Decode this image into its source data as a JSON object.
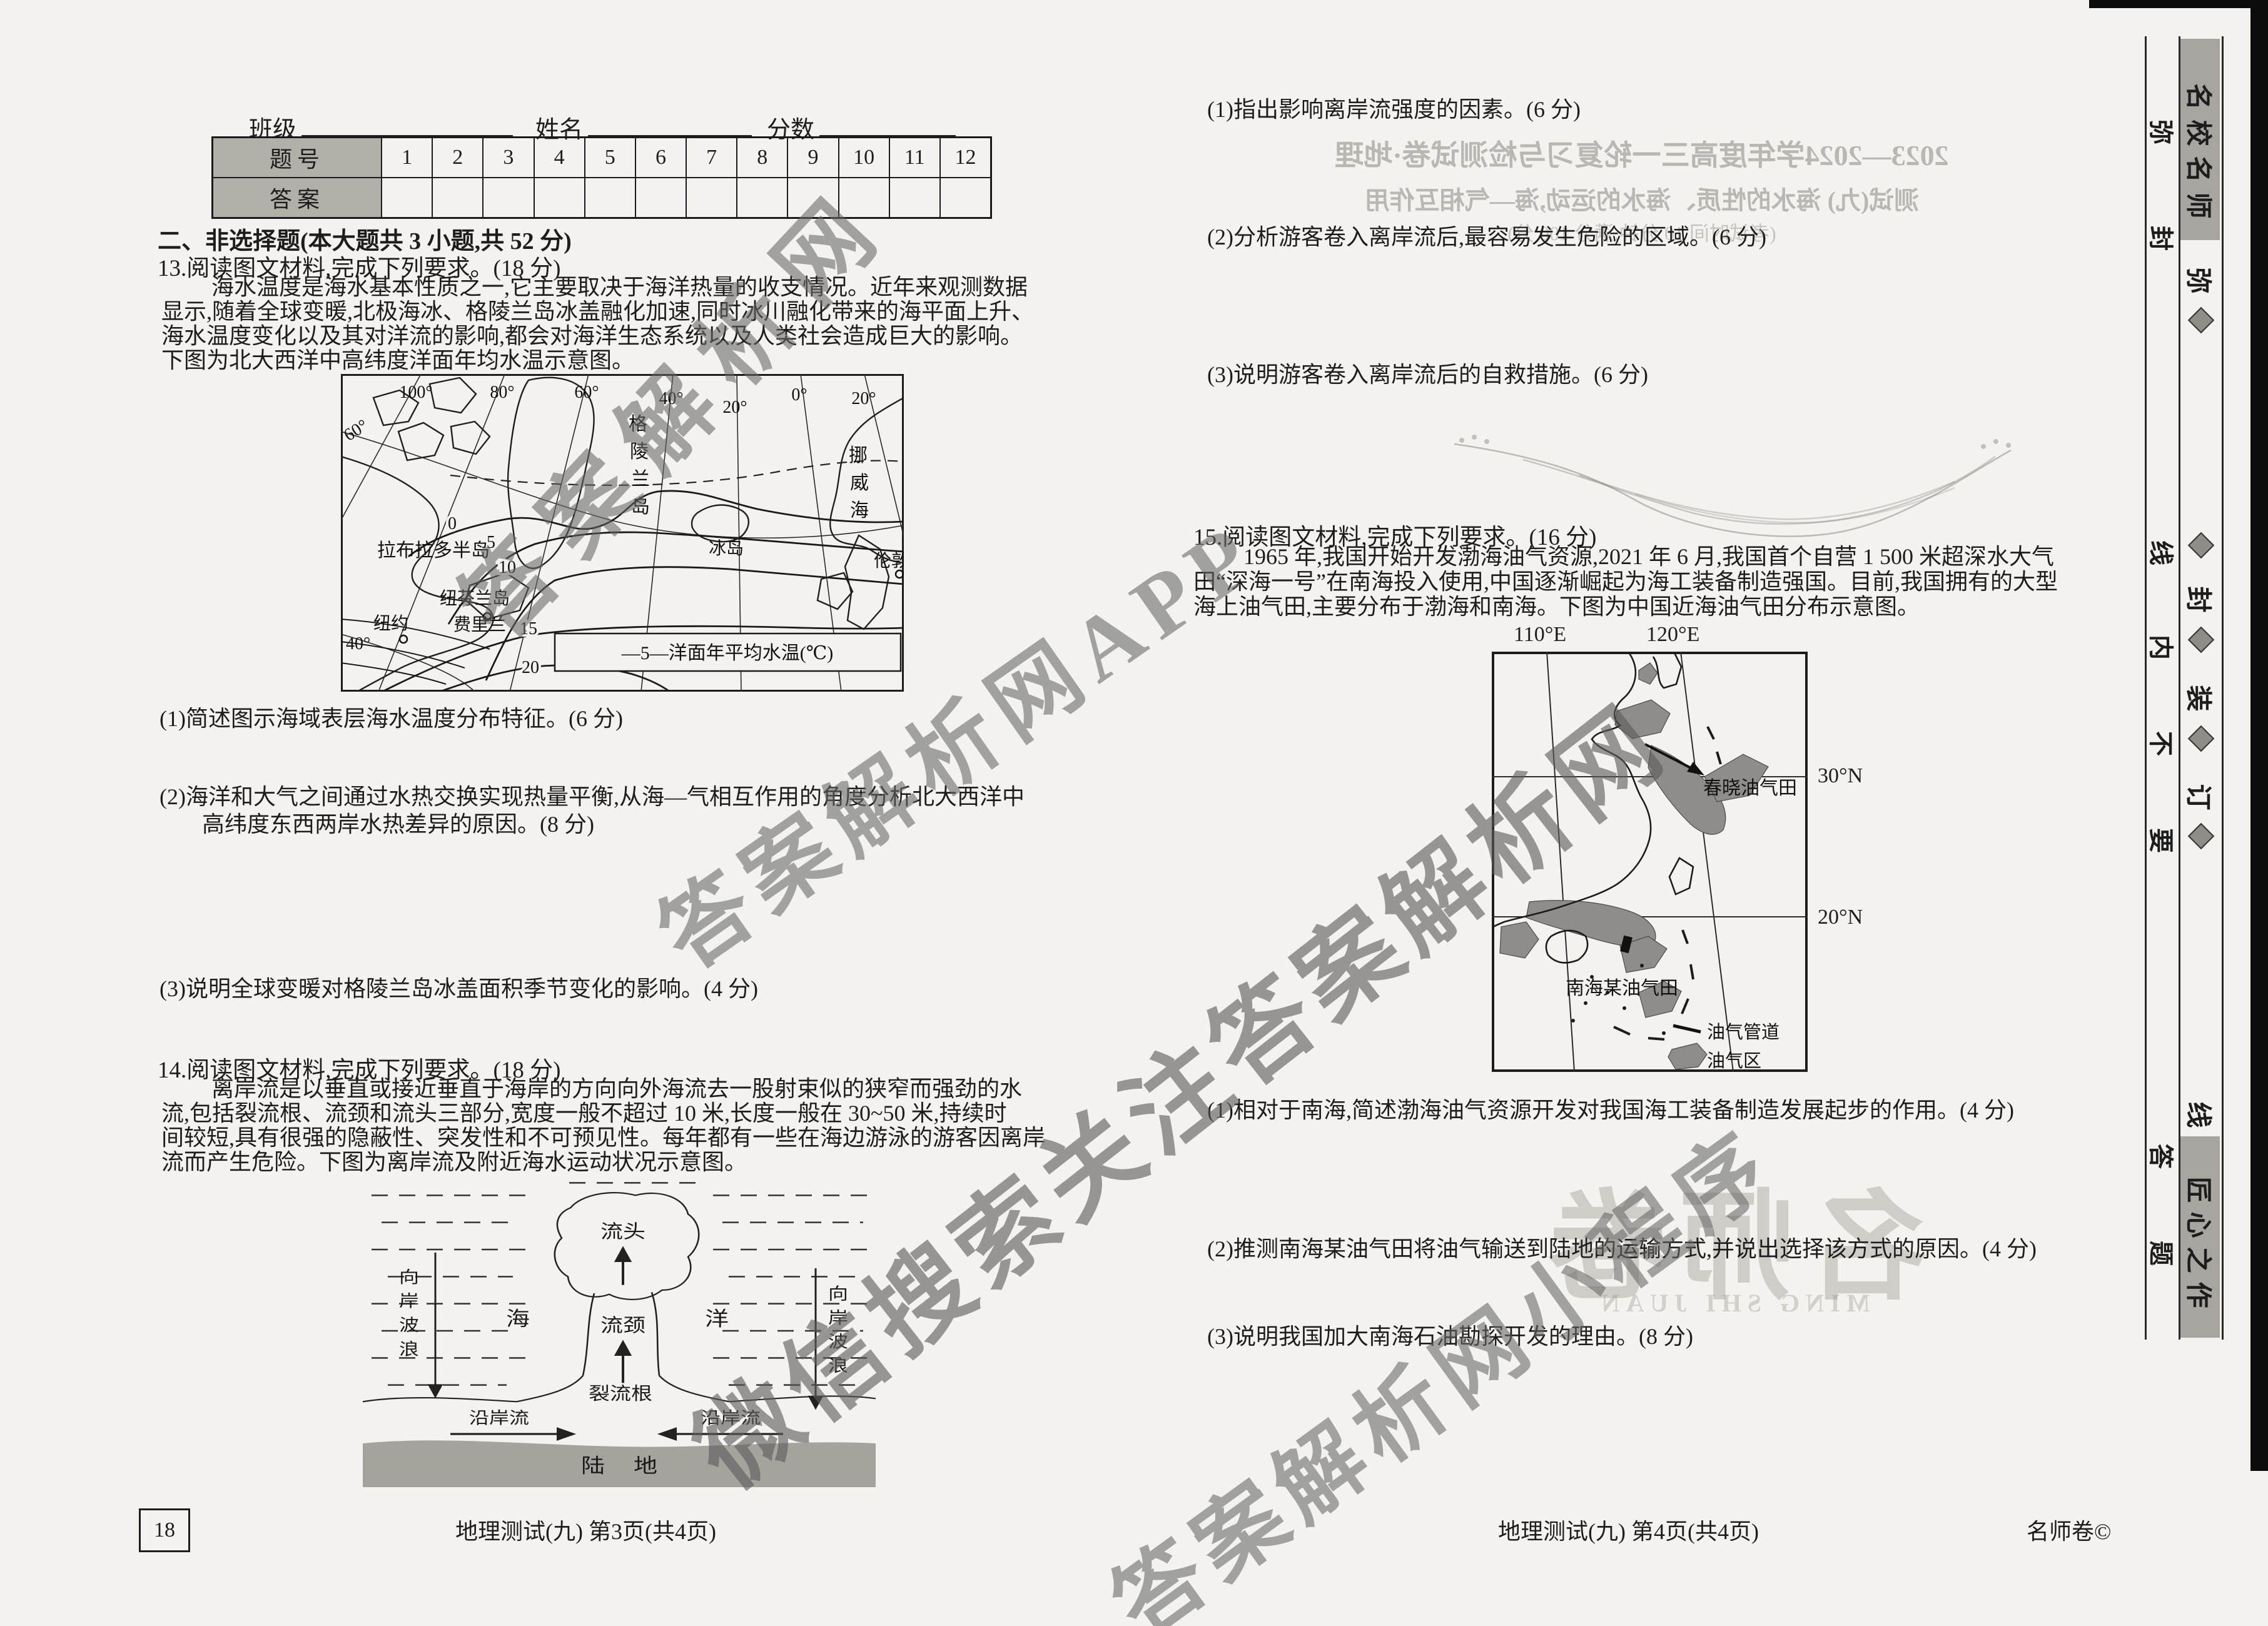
{
  "header": {
    "class_label": "班级",
    "name_label": "姓名",
    "score_label": "分数"
  },
  "answer_table": {
    "row_header": "题号",
    "answer_header": "答案",
    "numbers": [
      "1",
      "2",
      "3",
      "4",
      "5",
      "6",
      "7",
      "8",
      "9",
      "10",
      "11",
      "12"
    ]
  },
  "left": {
    "section_title": "二、非选择题(本大题共 3 小题,共 52 分)",
    "q13": {
      "stem": "13.阅读图文材料,完成下列要求。(18 分)",
      "para": [
        "海水温度是海水基本性质之一,它主要取决于海洋热量的收支情况。近年来观测数据",
        "显示,随着全球变暖,北极海冰、格陵兰岛冰盖融化加速,同时冰川融化带来的海平面上升、",
        "海水温度变化以及其对洋流的影响,都会对海洋生态系统以及人类社会造成巨大的影响。",
        "下图为北大西洋中高纬度洋面年均水温示意图。"
      ],
      "sub1": "(1)简述图示海域表层海水温度分布特征。(6 分)",
      "sub2_l1": "(2)海洋和大气之间通过水热交换实现热量平衡,从海—气相互作用的角度分析北大西洋中",
      "sub2_l2": "高纬度东西两岸水热差异的原因。(8 分)",
      "sub3": "(3)说明全球变暖对格陵兰岛冰盖面积季节变化的影响。(4 分)"
    },
    "map13": {
      "lon": [
        "100°",
        "80°",
        "60°",
        "40°",
        "20°",
        "0°",
        "20°"
      ],
      "lat_top": "60°",
      "lat_bottom": "40°",
      "iso": [
        "0",
        "5",
        "10",
        "15",
        "20"
      ],
      "greenland": [
        "格",
        "陵",
        "兰",
        "岛"
      ],
      "norwegian_sea": [
        "挪",
        "威",
        "海"
      ],
      "iceland": "冰岛",
      "labrador": "拉布拉多半岛",
      "newfoundland": "纽芬兰岛",
      "ferryland": "费里兰",
      "newyork": "纽约",
      "london": "伦敦",
      "legend": "—5—洋面年平均水温(℃)"
    },
    "q14": {
      "stem": "14.阅读图文材料,完成下列要求。(18 分)",
      "para": [
        "离岸流是以垂直或接近垂直于海岸的方向向外海流去一股射束似的狭窄而强劲的水",
        "流,包括裂流根、流颈和流头三部分,宽度一般不超过 10 米,长度一般在 30~50 米,持续时",
        "间较短,具有很强的隐蔽性、突发性和不可预见性。每年都有一些在海边游泳的游客因离岸",
        "流而产生危险。下图为离岸流及附近海水运动状况示意图。"
      ]
    },
    "fig14": {
      "head": "流头",
      "neck": "流颈",
      "root": "裂流根",
      "sea": "海",
      "ocean": "洋",
      "onshore": [
        "向",
        "岸",
        "波",
        "浪"
      ],
      "longshore": "沿岸流",
      "land": [
        "陆",
        "地"
      ]
    }
  },
  "right": {
    "q14_sub1": "(1)指出影响离岸流强度的因素。(6 分)",
    "q14_sub2": "(2)分析游客卷入离岸流后,最容易发生危险的区域。(6 分)",
    "q14_sub3": "(3)说明游客卷入离岸流后的自救措施。(6 分)",
    "q15": {
      "stem": "15.阅读图文材料,完成下列要求。(16 分)",
      "para": [
        "1965 年,我国开始开发渤海油气资源,2021 年 6 月,我国首个自营 1 500 米超深水大气",
        "田“深海一号”在南海投入使用,中国逐渐崛起为海工装备制造强国。目前,我国拥有的大型",
        "海上油气田,主要分布于渤海和南海。下图为中国近海油气田分布示意图。"
      ],
      "sub1": "(1)相对于南海,简述渤海油气资源开发对我国海工装备制造发展起步的作用。(4 分)",
      "sub2": "(2)推测南海某油气田将油气输送到陆地的运输方式,并说出选择该方式的原因。(4 分)",
      "sub3": "(3)说明我国加大南海石油勘探开发的理由。(8 分)"
    },
    "map15": {
      "lon": [
        "110°E",
        "120°E"
      ],
      "lat": [
        "30°N",
        "20°N"
      ],
      "chunxiao": "春晓油气田",
      "nanhai": "南海某油气田",
      "legend_pipeline": "油气管道",
      "legend_area": "油气区"
    }
  },
  "footer": {
    "left_box": "18",
    "left_text": "地理测试(九)  第3页(共4页)",
    "right_text": "地理测试(九)  第4页(共4页)",
    "brand": "名师卷©"
  },
  "sidebar": {
    "badge_top": [
      "名",
      "校",
      "名",
      "师"
    ],
    "badge_bottom": [
      "匠",
      "心",
      "之",
      "作"
    ],
    "inner": [
      "弥",
      "封",
      "线",
      "内",
      "不",
      "要",
      "答",
      "题"
    ],
    "outer": [
      "弥",
      "封",
      "装",
      "订",
      "线"
    ]
  },
  "watermarks": {
    "wm1": "答案解析网",
    "wm2": "答案解析网APP",
    "wm3": "微信搜索关注答案解析网",
    "wm4": "答案解析网小程序"
  },
  "bleed": {
    "title1": "2023—2024学年度高三一轮复习与检测试卷·地理",
    "title2": "测试(九)  海水的性质、海水的运动,海—气相互作用",
    "title3": "(考试时间 10 分钟,满分 100 分)",
    "logo": "名师卷",
    "logo_sub": "MING SHI JUAN"
  }
}
